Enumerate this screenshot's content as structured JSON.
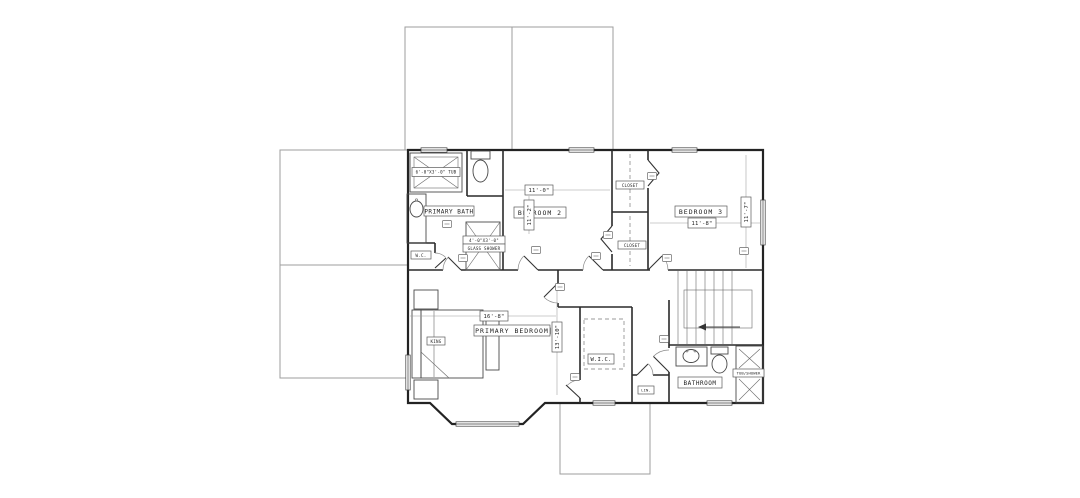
{
  "drawing": {
    "rooms": {
      "primary_bath": {
        "name": "PRIMARY BATH"
      },
      "water_closet": {
        "name": "W.C."
      },
      "bedroom2": {
        "name": "BEDROOM 2",
        "width": "11'-0\"",
        "depth": "11'-2\""
      },
      "bedroom3": {
        "name": "BEDROOM 3",
        "width": "11'-8\"",
        "depth": "11'-7\""
      },
      "closet_upper": {
        "name": "CLOSET"
      },
      "closet_lower": {
        "name": "CLOSET"
      },
      "primary_bedroom": {
        "name": "PRIMARY BEDROOM",
        "width": "16'-8\"",
        "depth": "13'-10\""
      },
      "wic": {
        "name": "W.I.C."
      },
      "linen": {
        "name": "LIN."
      },
      "bathroom": {
        "name": "BATHROOM"
      }
    },
    "fixtures": {
      "primary_tub": "6'-0\"X3'-0\" TUB",
      "shower_size": "4'-0\"X3'-0\"",
      "shower_type": "GLASS SHOWER",
      "hall_tub": "TUB/SHOWER",
      "bed": "KING"
    }
  }
}
